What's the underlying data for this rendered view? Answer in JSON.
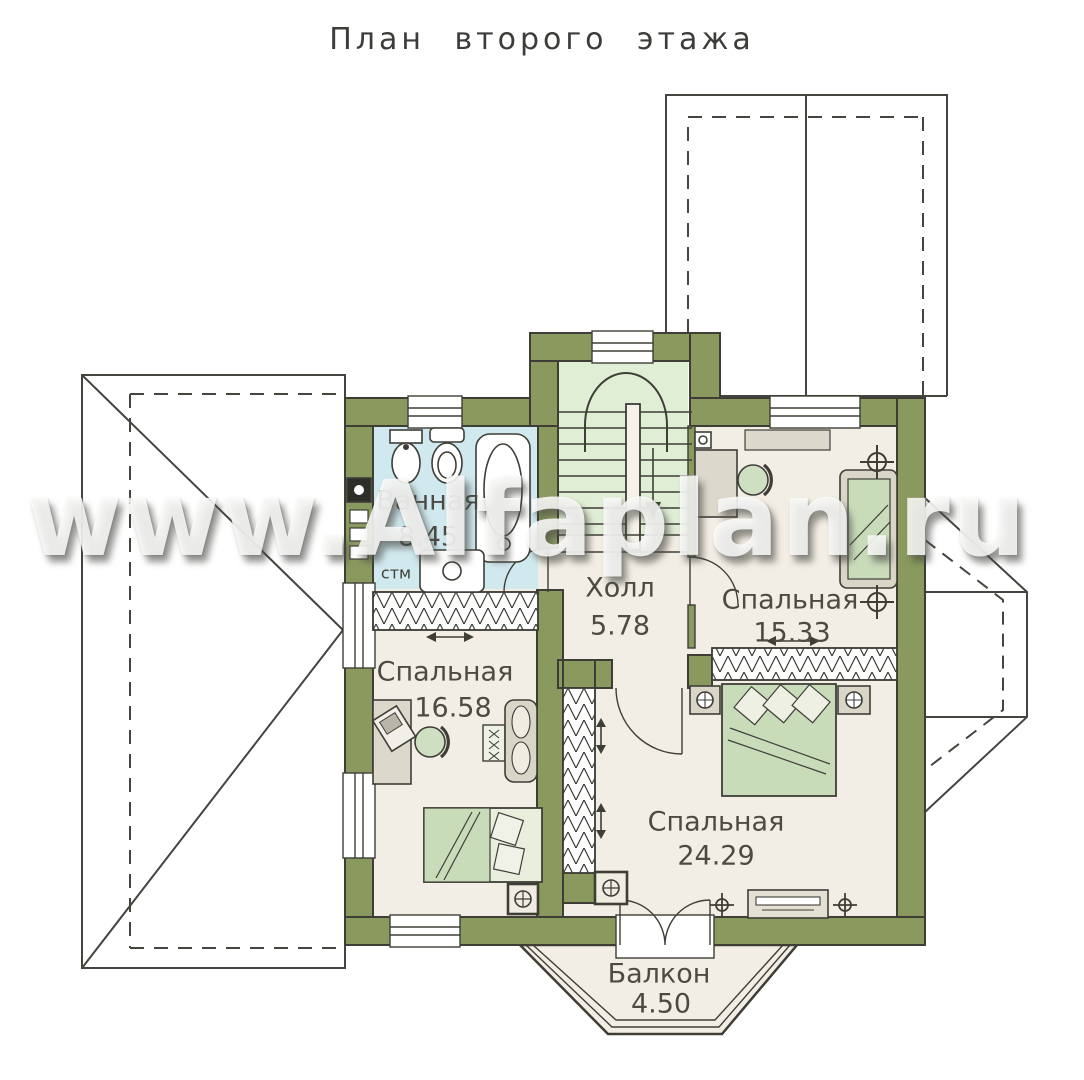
{
  "title": "План второго этажа",
  "watermark": "www.Alfaplan.ru",
  "rooms": {
    "bathroom": {
      "name": "Ванная",
      "area": "8.45"
    },
    "hall": {
      "name": "Холл",
      "area": "5.78"
    },
    "bedroom_top": {
      "name": "Спальная",
      "area": "15.33"
    },
    "bedroom_left": {
      "name": "Спальная",
      "area": "16.58"
    },
    "bedroom_big": {
      "name": "Спальная",
      "area": "24.29"
    },
    "balcony": {
      "name": "Балкон",
      "area": "4.50"
    }
  },
  "labels": {
    "washing_machine": "стм"
  },
  "colors": {
    "wall": "#8a9a5f",
    "line": "#3e3e37",
    "floor": "#f3eee5",
    "bathroom_floor": "#cfe9ef",
    "stair_floor": "#e1eed6",
    "bed_green": "#c9dcba",
    "furniture_gray": "#d9d5c7"
  }
}
